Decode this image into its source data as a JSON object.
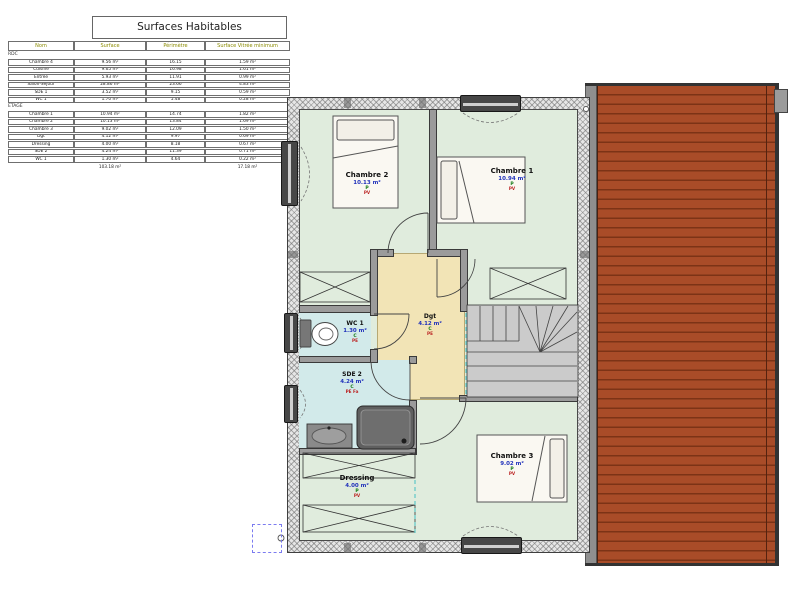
{
  "table": {
    "title": "Surfaces Habitables",
    "columns": [
      "Nom",
      "Surface",
      "Périmètre",
      "Surface Vitrée minimum"
    ],
    "sections": [
      {
        "label": "RDC",
        "rows": [
          [
            "Chambre 4",
            "9.56 m²",
            "16.15",
            "1.59 m²"
          ],
          [
            "Cuisine",
            "9.65 m²",
            "16.98",
            "1.61 m²"
          ],
          [
            "Entrée",
            "5.93 m²",
            "11.91",
            "0.99 m²"
          ],
          [
            "Salon-Séjour",
            "28.86 m²",
            "23.66",
            "4.83 m²"
          ],
          [
            "SDE 1",
            "3.52 m²",
            "9.15",
            "0.59 m²"
          ],
          [
            "WC 1",
            "1.70 m²",
            "5.48",
            "0.28 m²"
          ]
        ]
      },
      {
        "label": "ETAGE",
        "rows": [
          [
            "Chambre 1",
            "10.94 m²",
            "14.74",
            "1.82 m²"
          ],
          [
            "Chambre 2",
            "10.13 m²",
            "13.84",
            "1.69 m²"
          ],
          [
            "Chambre 3",
            "9.02 m²",
            "12.09",
            "1.50 m²"
          ],
          [
            "Dgt",
            "4.12 m²",
            "9.97",
            "0.69 m²"
          ],
          [
            "Dressing",
            "4.00 m²",
            "8.18",
            "0.67 m²"
          ],
          [
            "SDE 2",
            "4.24 m²",
            "11.39",
            "0.71 m²"
          ],
          [
            "WC 1",
            "1.30 m²",
            "4.64",
            "0.22 m²"
          ]
        ]
      }
    ],
    "totals": {
      "surface": "103.18 m²",
      "surface_vitree": "17.18 m²"
    }
  },
  "plan": {
    "rooms": [
      {
        "name": "Chambre 2",
        "area": "10.13 m²",
        "floor_code": "P",
        "wall_code": "PV"
      },
      {
        "name": "Chambre 1",
        "area": "10.94 m²",
        "floor_code": "P",
        "wall_code": "PV"
      },
      {
        "name": "WC 1",
        "area": "1.30 m²",
        "floor_code": "C",
        "wall_code": "PE"
      },
      {
        "name": "Dgt",
        "area": "4.12 m²",
        "floor_code": "C",
        "wall_code": "PE"
      },
      {
        "name": "SDE 2",
        "area": "4.24 m²",
        "floor_code": "C",
        "wall_code": "PE Fa"
      },
      {
        "name": "Dressing",
        "area": "4.00 m²",
        "floor_code": "P",
        "wall_code": "PV"
      },
      {
        "name": "Chambre 3",
        "area": "9.02 m²",
        "floor_code": "P",
        "wall_code": "PV"
      }
    ],
    "colors": {
      "floor_green": "#e0ecdd",
      "floor_beige": "#f2e4b6",
      "floor_blue": "#d2eaea",
      "wall_gray": "#9b9b9b",
      "roof_red": "#a94c28",
      "roof_line": "#7c3316",
      "area_text": "#2233bb",
      "floor_code_text": "#117711",
      "wall_code_text": "#bb2222"
    }
  }
}
